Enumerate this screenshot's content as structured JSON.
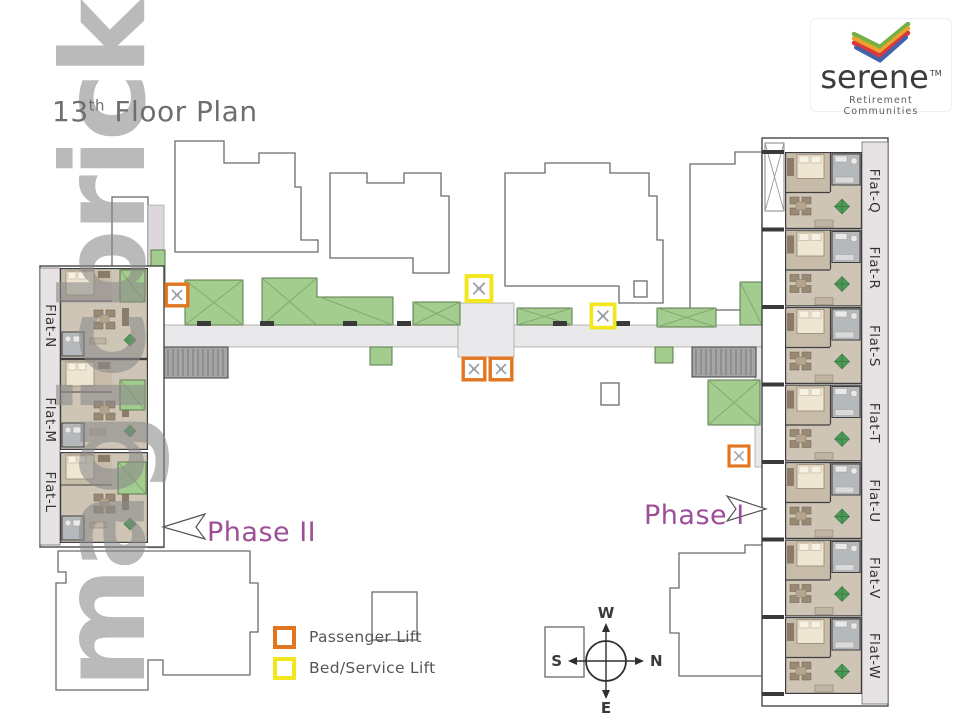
{
  "title": {
    "number": "13",
    "ordinal": "th",
    "text": " Floor Plan"
  },
  "watermark": "magicbricks",
  "logo": {
    "brand": "serene",
    "trademark": "TM",
    "tagline": "Retirement Communities"
  },
  "plan": {
    "phase_left": "Phase II",
    "phase_right": "Phase I",
    "flats_left": [
      "Flat-N",
      "Flat-M",
      "Flat-L"
    ],
    "flats_right": [
      "Flat-Q",
      "Flat-R",
      "Flat-S",
      "Flat-T",
      "Flat-U",
      "Flat-V",
      "Flat-W"
    ]
  },
  "legend": {
    "items": [
      {
        "label": "Passenger Lift",
        "color": "#e2751f"
      },
      {
        "label": "Bed/Service Lift",
        "color": "#f2e71d"
      }
    ]
  },
  "compass": {
    "top": "W",
    "right": "N",
    "bottom": "E",
    "left": "S"
  },
  "colors": {
    "phase_text": "#9c4f96",
    "garden_green": "#a3cc8f",
    "corridor": "#e9e9eb",
    "passenger_lift": "#e2751f",
    "bed_service_lift": "#f2e71d"
  }
}
